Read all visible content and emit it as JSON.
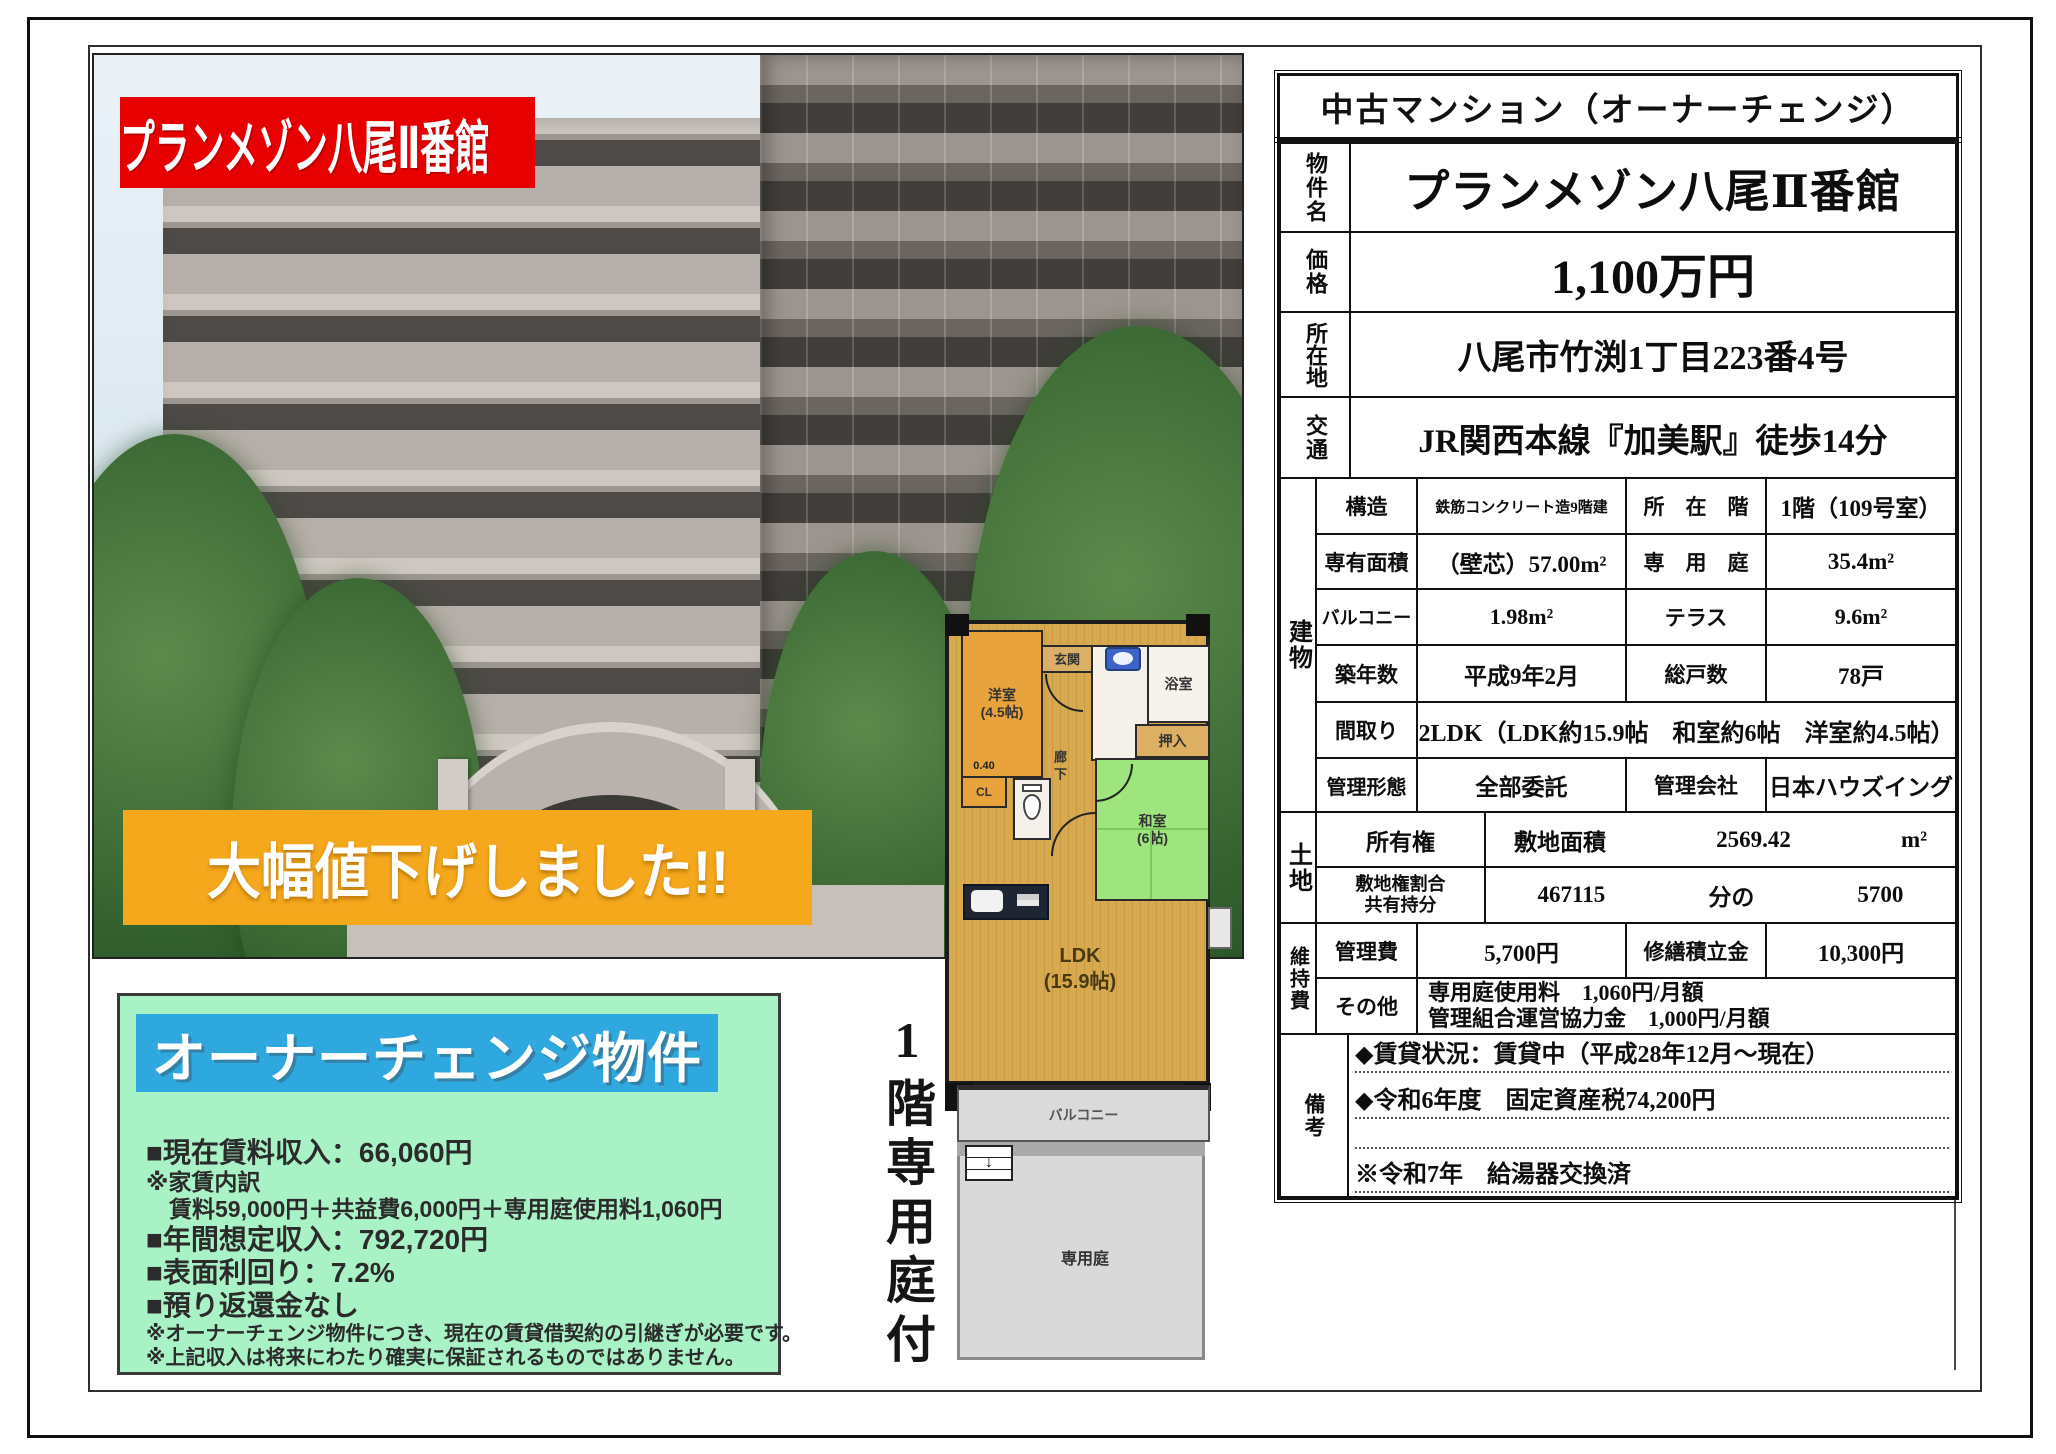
{
  "colors": {
    "banner_red": "#e60000",
    "banner_orange": "#f5a81c",
    "box_mint": "#a9f2c6",
    "title_blue": "#2fa7df",
    "wood": "#d8a94e",
    "tatami_green": "#9fe57e",
    "western_orange": "#e8a33c"
  },
  "photo": {
    "title_banner": "プランメゾン八尾Ⅱ番館",
    "sale_banner": "大幅値下げしました!!"
  },
  "owner_box": {
    "title": "オーナーチェンジ物件",
    "lines": [
      "■現在賃料収入：66,060円",
      "※家賃内訳",
      "　賃料59,000円＋共益費6,000円＋専用庭使用料1,060円",
      "■年間想定収入：792,720円",
      "■表面利回り：7.2%",
      "■預り返還金なし",
      "※オーナーチェンジ物件につき、現在の賃貸借契約の引継ぎが必要です。",
      "※上記収入は将来にわたり確実に保証されるものではありません。"
    ]
  },
  "floorplan": {
    "caption_vertical": "1階専用庭付",
    "dim_cl": "0.40",
    "rooms": {
      "entrance": "玄関",
      "western": "洋室\n(4.5帖)",
      "bath": "浴室",
      "oshiire": "押入",
      "japanese": "和室\n(6帖)",
      "hall": "廊下",
      "cl": "CL",
      "ldk": "LDK\n(15.9帖)",
      "balcony": "バルコニー",
      "garden": "専用庭",
      "stairs_arrow": "↓"
    }
  },
  "spec": {
    "header": "中古マンション（オーナーチェンジ）",
    "rows_top": [
      {
        "label": "物件名",
        "value": "プランメゾン八尾Ⅱ番館"
      },
      {
        "label": "価格",
        "value": "1,100万円"
      },
      {
        "label": "所在地",
        "value": "八尾市竹渕1丁目223番4号"
      },
      {
        "label": "交通",
        "value": "JR関西本線『加美駅』徒歩14分"
      }
    ],
    "building": {
      "section": "建物",
      "rows": [
        {
          "l1": "構造",
          "v1": "鉄筋コンクリート造9階建",
          "l2": "所　在　階",
          "v2": "1階（109号室）"
        },
        {
          "l1": "専有面積",
          "v1": "（壁芯）57.00m²",
          "l2": "専　用　庭",
          "v2": "35.4m²"
        },
        {
          "l1": "バルコニー",
          "v1": "1.98m²",
          "l2": "テラス",
          "v2": "9.6m²"
        },
        {
          "l1": "築年数",
          "v1": "平成9年2月",
          "l2": "総戸数",
          "v2": "78戸"
        },
        {
          "l1": "間取り",
          "v1": "2LDK（LDK約15.9帖　和室約6帖　洋室約4.5帖）"
        },
        {
          "l1": "管理形態",
          "v1": "全部委託",
          "l2": "管理会社",
          "v2": "日本ハウズイング"
        }
      ]
    },
    "land": {
      "section": "土地",
      "ownership": {
        "l1": "所有権",
        "l2": "敷地面積",
        "v": "2569.42",
        "unit": "m²"
      },
      "share": {
        "label": "敷地権割合\n共有持分",
        "v1": "467115",
        "mid": "分の",
        "v2": "5700"
      }
    },
    "maintenance": {
      "section": "維持費",
      "fees": {
        "l1": "管理費",
        "v1": "5,700円",
        "l2": "修繕積立金",
        "v2": "10,300円"
      },
      "other": {
        "l1": "その他",
        "value": "専用庭使用料　1,060円/月額\n管理組合運営協力金　1,000円/月額"
      }
    },
    "remarks": {
      "section": "備考",
      "lines": [
        "◆賃貸状況：賃貸中（平成28年12月～現在）",
        "◆令和6年度　固定資産税74,200円",
        "",
        "※令和7年　給湯器交換済"
      ]
    }
  }
}
